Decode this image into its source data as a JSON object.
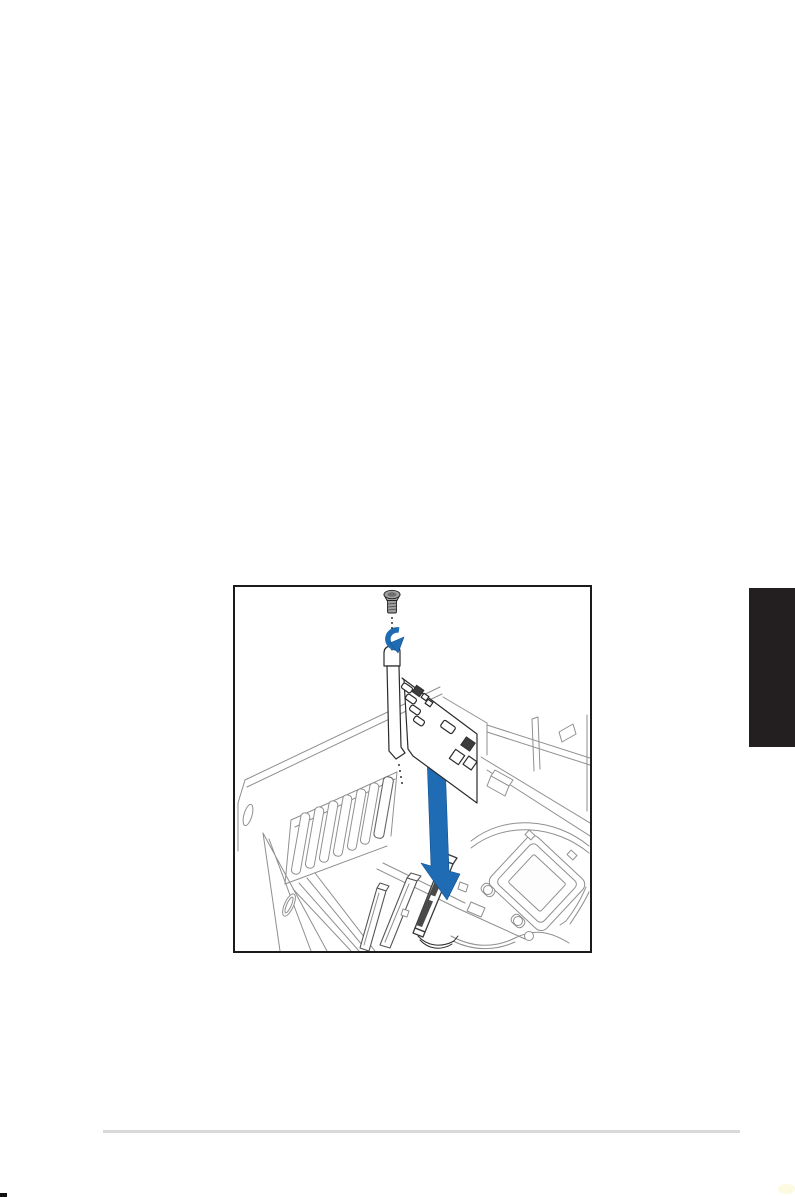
{
  "page": {
    "width_px": 795,
    "height_px": 1197,
    "background_color": "#ffffff"
  },
  "figure": {
    "kind": "line-art-technical-illustration",
    "subject": "Installing an expansion card into the chassis expansion slot",
    "frame_color": "#1b1b1b",
    "chassis_line_color": "#8f8f8f",
    "card_line_color": "#2b2b2b",
    "accent_blue": "#1f6cb4",
    "arrow_outline_blue": "#11508f",
    "screw_fill": "#9f9f9f",
    "slot_groove_color": "#4a4a4a",
    "parts": [
      "screw",
      "screw-rotation-arrow",
      "card-bracket",
      "expansion-card",
      "insertion-arrow",
      "chassis-rear-slot-openings",
      "motherboard-expansion-slots",
      "cpu-socket",
      "chassis-linework"
    ]
  },
  "chapter_tab": {
    "fill_color": "#231f20"
  },
  "footer": {
    "rule_color": "#d9d9d9",
    "corner_mark_color": "#111111"
  }
}
